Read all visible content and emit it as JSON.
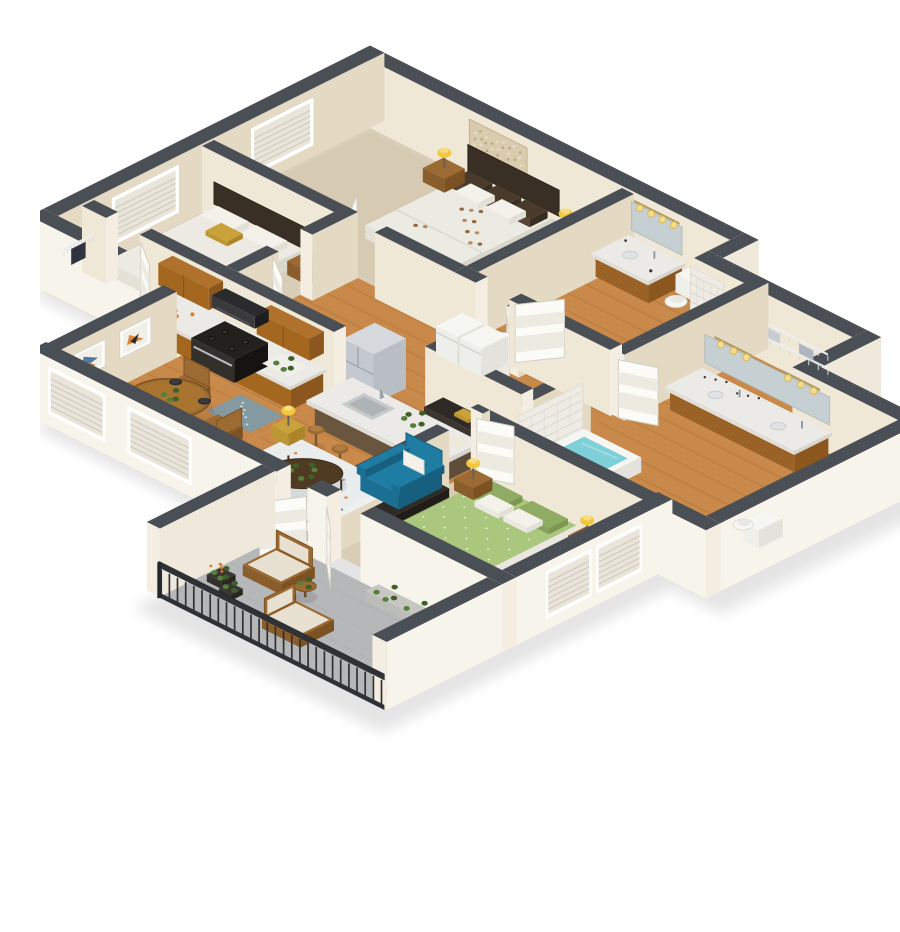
{
  "meta": {
    "caption": "3D isometric apartment floor plan rendering"
  },
  "palette": {
    "wallCap": "#4a4e55",
    "wallCapDark": "#40444b",
    "wallCream": "#f0e8d6",
    "wallCreamDark": "#e4dac4",
    "wallWhite": "#f7f4ec",
    "wallWhiteDark": "#efe9dc",
    "wallEnd": "#f3eee1",
    "floorWood": "#c8894a",
    "floorWoodLine": "#a66c30",
    "floorCarpet": "#d8cdb6",
    "floorCarpetDark": "#cfc3aa",
    "floorPatio": "#b5b7b8",
    "patioLine": "#a9abad",
    "water": "#7fd0d8",
    "waterLight": "#aee3e8",
    "marble": "#eceae6",
    "marbleSide": "#d8d5cf",
    "oak": "#b0712d",
    "oakDark": "#8c571f",
    "steel": "#b9bec4",
    "steelLight": "#d6d9dd",
    "white": "#f6f6f3",
    "whiteShade": "#e3e2dc",
    "blue": "#1f7da4",
    "blueDark": "#175f7e",
    "green": "#abc77e",
    "greenDark": "#90ac64",
    "yellow": "#f2c73d",
    "gold": "#c9a23c",
    "dark": "#2e2a25",
    "darkLine": "#46413a",
    "wood": "#9c6a33",
    "woodDark": "#7c5222",
    "rail": "#2e3136",
    "rug": "#eef1f1",
    "mat": "#7f9aa8",
    "orange": "#d97b2e",
    "artBlue": "#3a6f9e",
    "plant": "#557f3a",
    "plantDark": "#3f6129",
    "mirror": "#c6d0d3",
    "tile": "#edebe4",
    "tileLine": "#d7d3c8",
    "cushion": "#e8e1d1",
    "duvet": "#ecebe3",
    "pillow": "#f3f1ea",
    "brown": "#4a3a2c"
  },
  "scene": {
    "rooms": [
      {
        "id": "bedroom-1",
        "floor": "carpet",
        "items": [
          "queen-bed-floral-duvet",
          "dark-headboard",
          "nightstand-left",
          "nightstand-right",
          "table-lamp-yellow",
          "table-lamp-yellow",
          "wall-art-shimmer-panel",
          "window-blinds",
          "closet-hanging-clothes"
        ]
      },
      {
        "id": "bathroom-1",
        "floor": "wood",
        "items": [
          "wood-vanity-marble-top",
          "sink",
          "mirror",
          "vanity-light-bar-4-bulbs",
          "toilet",
          "bathtub-teal-water",
          "tile-accent-wall"
        ]
      },
      {
        "id": "bedroom-2",
        "floor": "carpet",
        "items": [
          "bed-white-bedding",
          "gold-accent-pillow",
          "nightstand",
          "table-lamp-yellow",
          "window-blinds"
        ]
      },
      {
        "id": "entry-pantry",
        "floor": "wood",
        "items": [
          "wire-shelving"
        ]
      },
      {
        "id": "kitchen",
        "floor": "wood",
        "items": [
          "upper-oak-cabinets",
          "base-oak-cabinets-marble-counter",
          "black-range-cooktop",
          "microwave",
          "fruit-bowl",
          "cutting-board",
          "patterned-kitchen-mat",
          "stainless-fridge",
          "washer",
          "dryer"
        ]
      },
      {
        "id": "dining-area",
        "floor": "wood",
        "items": [
          "round-wood-table",
          "four-wood-chairs",
          "black-place-settings",
          "centerpiece-plant",
          "two-abstract-art-frames",
          "window-blinds"
        ]
      },
      {
        "id": "living-room",
        "floor": "wood",
        "items": [
          "kitchen-island-marble-sink",
          "three-wood-barstools",
          "teal-armchair-white-pillow",
          "oval-coffee-table-plant",
          "dotted-white-rug",
          "gold-cube-side-table",
          "yellow-drum-lamp",
          "yellow-drum-lamp",
          "planter-box",
          "window-blinds",
          "dark-media-console"
        ]
      },
      {
        "id": "hallway",
        "floor": "wood",
        "items": [
          "white-panel-doors"
        ]
      },
      {
        "id": "walk-in-closet",
        "floor": "wood",
        "items": [
          "wire-shelving",
          "hanging-clothes",
          "bifold-doors"
        ]
      },
      {
        "id": "bathroom-2",
        "floor": "wood",
        "items": [
          "double-wood-vanity-marble-top",
          "two-sinks",
          "mirror",
          "vanity-light-bars",
          "toiletries",
          "toilet",
          "bathtub-teal-water",
          "tile-accent-wall"
        ]
      },
      {
        "id": "bedroom-3",
        "floor": "carpet",
        "items": [
          "queen-bed-green-patterned-duvet",
          "green-pillows",
          "dark-dresser",
          "dark-bench",
          "nightstand-left",
          "nightstand-right",
          "table-lamp-yellow",
          "table-lamp-yellow",
          "double-window-blinds"
        ]
      },
      {
        "id": "patio",
        "floor": "concrete",
        "items": [
          "metal-railing",
          "two-wood-armchairs-cream-cushions",
          "round-wood-side-table",
          "planter-boxes",
          "flower-pots",
          "white-round-table"
        ]
      }
    ]
  }
}
